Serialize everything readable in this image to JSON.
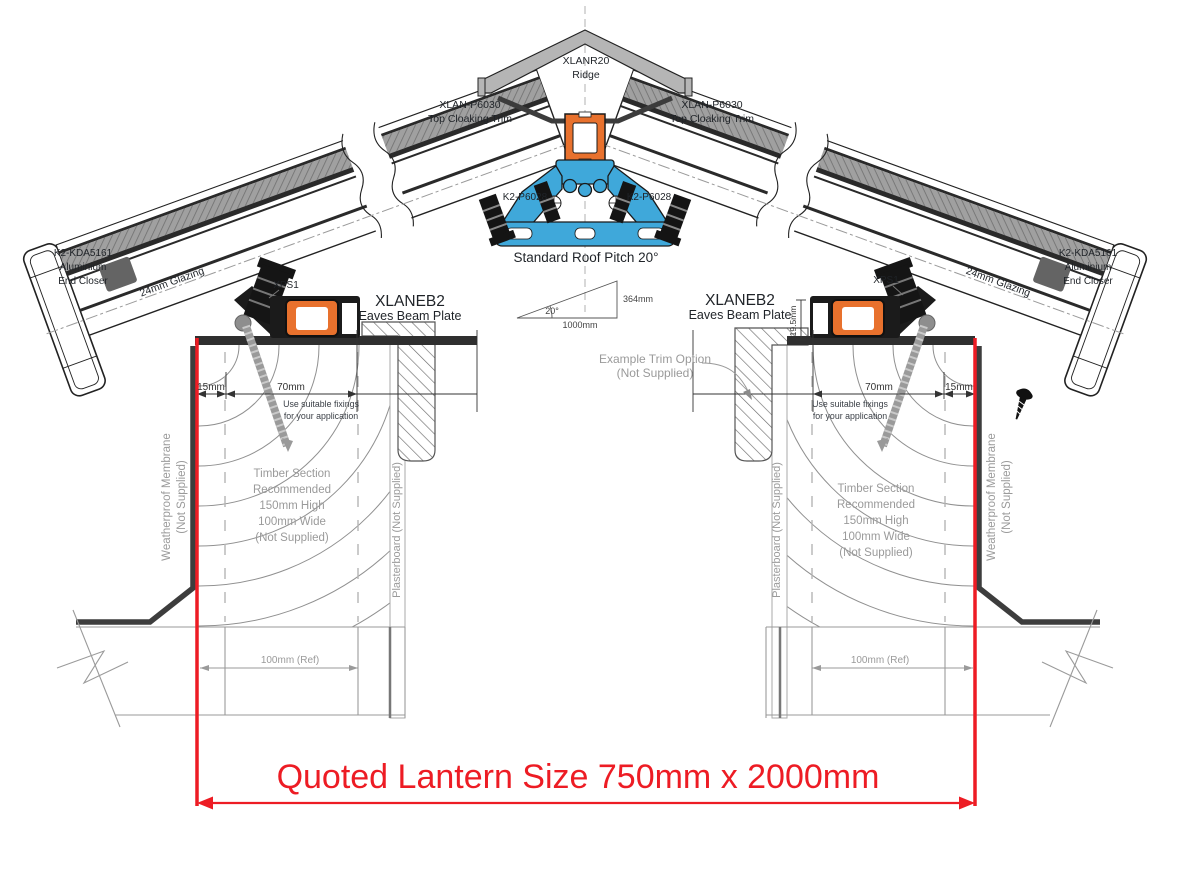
{
  "drawing": {
    "colors": {
      "accent_red": "#ED1C24",
      "profile_orange": "#E8712D",
      "profile_blue": "#3FA8DA",
      "steel_gray": "#b5b5b5",
      "annotation_gray": "#999999",
      "line_black": "#1f1f1f"
    },
    "ridge": {
      "code": "XLANR20",
      "name": "Ridge"
    },
    "top_cloaking": {
      "code": "XLAN-P6030",
      "name": "Top Cloaking Trim"
    },
    "ridge_fixing_code": "K2-P6028",
    "pitch_note": "Standard Roof Pitch 20°",
    "pitch_triangle": {
      "rise": "364mm",
      "angle": "20°",
      "base": "1000mm"
    },
    "end_closer": {
      "code": "K2-KDA5161",
      "material": "Aluminium",
      "name": "End Closer"
    },
    "glazing_note": "24mm Glazing",
    "insulation_code": "XPS1",
    "eaves_beam": {
      "code": "XLANEB2",
      "name": "Eaves Beam Plate"
    },
    "example_trim": {
      "line1": "Example  Trim Option",
      "line2": "(Not Supplied)"
    },
    "fixing_note": {
      "line1": "Use suitable fixings",
      "line2": "for your application"
    },
    "timber_note": {
      "line1": "Timber Section",
      "line2": "Recommended",
      "line3": "150mm High",
      "line4": "100mm Wide",
      "line5": "(Not Supplied)"
    },
    "membrane_note": {
      "line1": "Weatherproof Membrane",
      "line2": "(Not Supplied)"
    },
    "plasterboard_note": "Plasterboard (Not Supplied)",
    "dimensions": {
      "edge": "15mm",
      "fixing_zone": "70mm",
      "upstand": "19.5mm",
      "wall_ref": "100mm (Ref)"
    },
    "quoted_size": "Quoted Lantern Size 750mm x 2000mm"
  }
}
